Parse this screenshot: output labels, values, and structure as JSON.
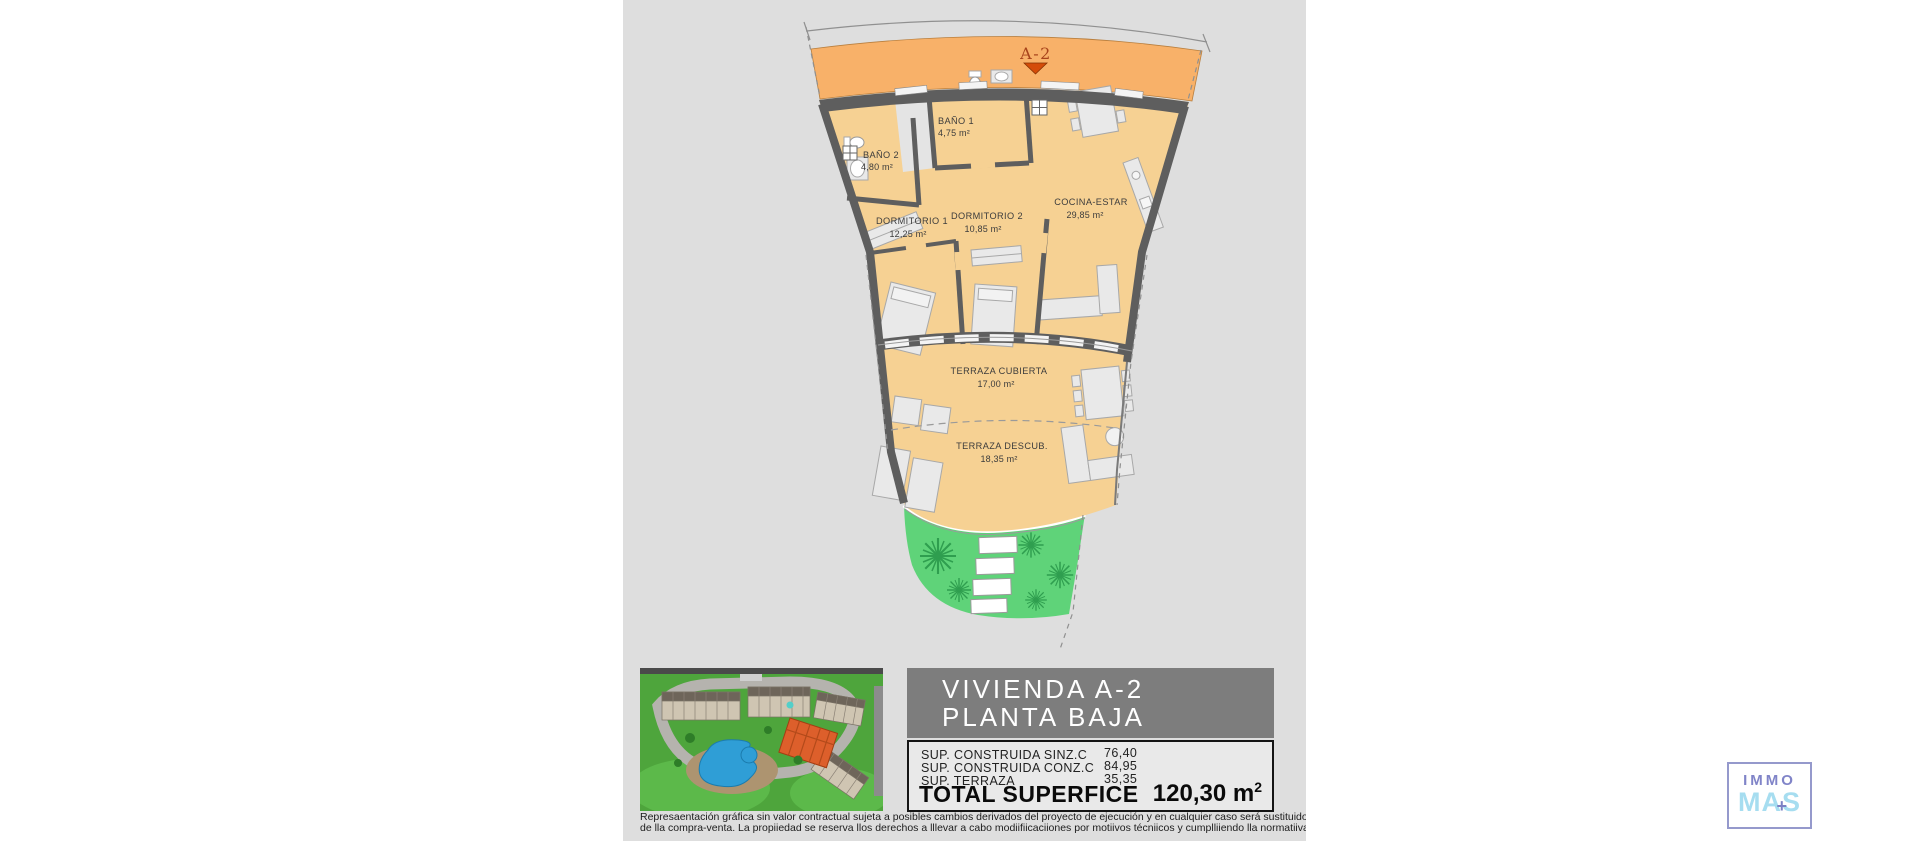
{
  "plan": {
    "marker": {
      "label": "A-2"
    },
    "rooms": [
      {
        "name": "BAÑO 1",
        "area": "4,75 m²"
      },
      {
        "name": "BAÑO 2",
        "area": "4,80 m²"
      },
      {
        "name": "DORMITORIO 1",
        "area": "12,25 m²"
      },
      {
        "name": "DORMITORIO 2",
        "area": "10,85 m²"
      },
      {
        "name": "COCINA-ESTAR",
        "area": "29,85 m²"
      },
      {
        "name": "TERRAZA CUBIERTA",
        "area": "17,00 m²"
      },
      {
        "name": "TERRAZA DESCUB.",
        "area": "18,35 m²"
      }
    ],
    "colors": {
      "background_gray": "#dedede",
      "floor": "#f6d193",
      "common_band": "#f8b169",
      "walls": "#5e5e5e",
      "garden_green": "#5fd379",
      "tree_green": "#2f9e4f",
      "marker_red": "#d44c09"
    }
  },
  "info_panel": {
    "title_line1": "VIVIENDA A-2",
    "title_line2": "PLANTA BAJA",
    "rows": [
      {
        "label": "SUP. CONSTRUIDA SINZ.C",
        "value": "76,40"
      },
      {
        "label": "SUP. CONSTRUIDA CONZ.C",
        "value": "84,95"
      },
      {
        "label": "SUP. TERRAZA",
        "value": "35,35"
      }
    ],
    "total_label": "TOTAL SUPERFICE",
    "total_value": "120,30 m",
    "total_sup": "2"
  },
  "disclaimer": {
    "line1": "Represaentación gráfica sin valor contractual sujeta a posibles cambios derivados del proyecto de ejecución y en cualquier caso será sustituido por el definitivo er",
    "line2": "de lla compra-venta. La propiiedad se reserva llos derechos a lllevar a cabo modiifiicaciiones por motiivos técniicos y cumplliiendo lla normatiiva viigente."
  },
  "logo": {
    "immo": "IMMO",
    "mas_a": "MA",
    "plus": "+",
    "mas_b": "S"
  }
}
